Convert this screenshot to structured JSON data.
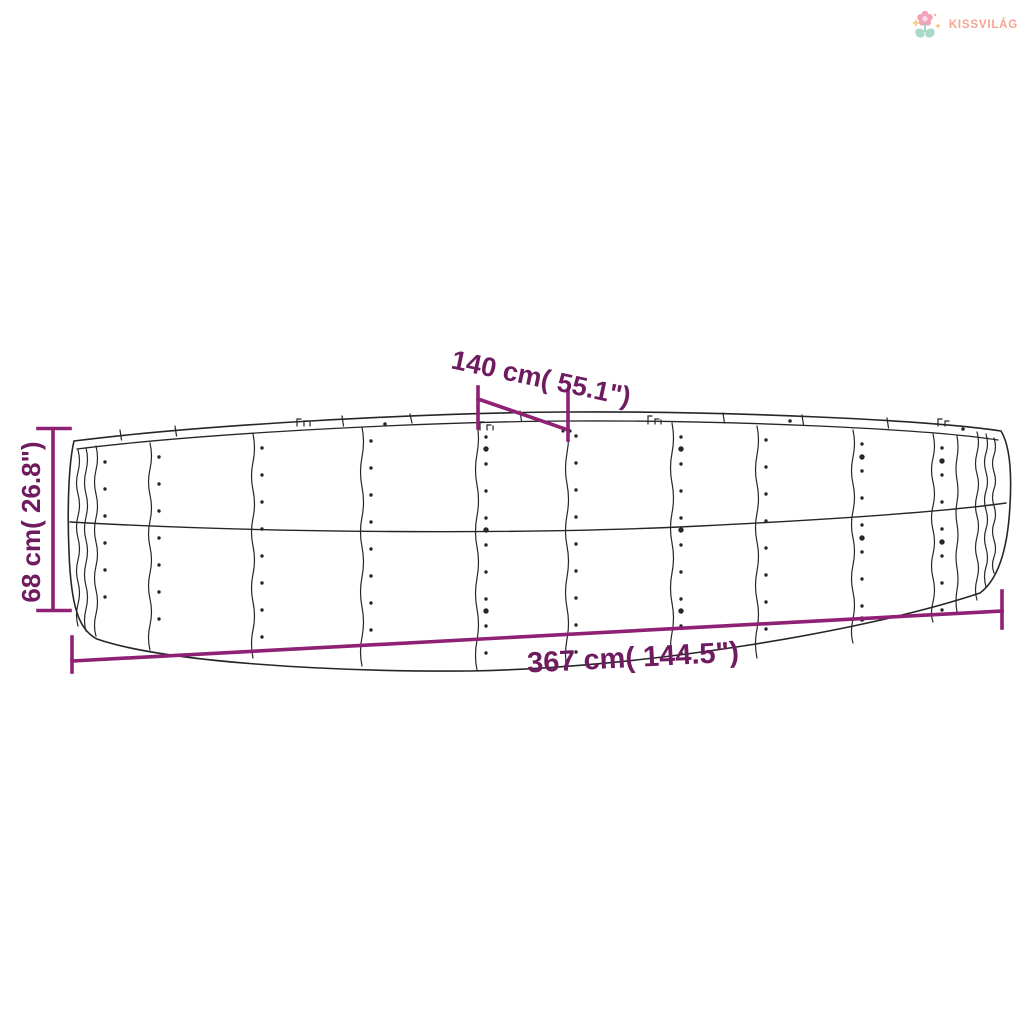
{
  "logo": {
    "brand": "KISSVILÁG",
    "icon": "flower-icon",
    "text_color": "#F5A492"
  },
  "diagram": {
    "subject": "oval corrugated-steel raised garden bed, line drawing",
    "labels": {
      "top": "140 cm( 55.1\")",
      "left": "68 cm( 26.8\")",
      "bottom": "367 cm( 144.5\")"
    },
    "colors": {
      "dimension_text": "#6F1B60",
      "dimension_line": "#8E2173",
      "drawing": "#262626"
    }
  }
}
